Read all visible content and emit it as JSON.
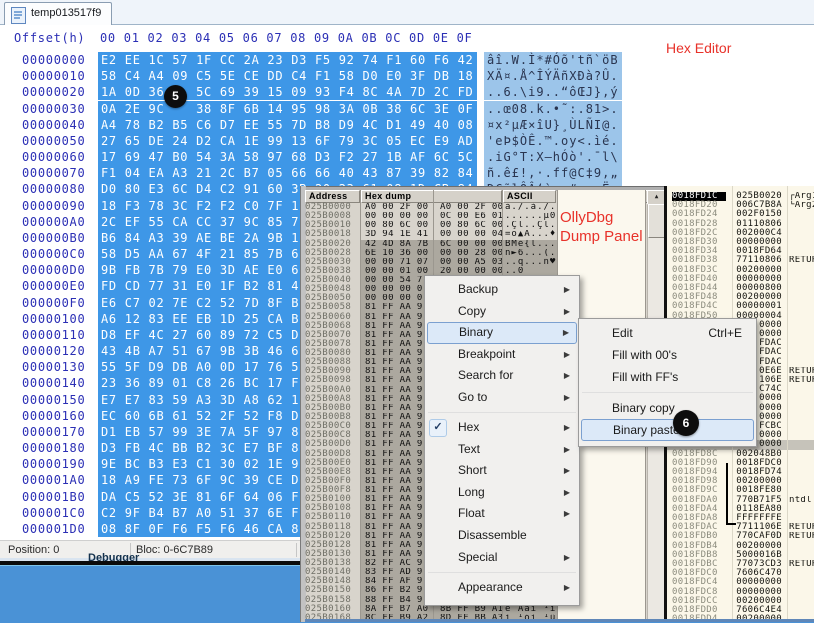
{
  "hex_editor": {
    "tab_title": "temp013517f9",
    "offset_label": "Offset(h)",
    "columns": [
      "00",
      "01",
      "02",
      "03",
      "04",
      "05",
      "06",
      "07",
      "08",
      "09",
      "0A",
      "0B",
      "0C",
      "0D",
      "0E",
      "0F"
    ],
    "rows": [
      {
        "offset": "00000000",
        "bytes": "E2 EE 1C 57 1F CC 2A 23 D3 F5 92 74 F1 60 F6 42",
        "ascii": "âî.W.Ì*#Óõ'tñ`öB"
      },
      {
        "offset": "00000010",
        "bytes": "58 C4 A4 09 C5 5E CE DD C4 F1 58 D0 E0 3F DB 18",
        "ascii": "XÄ¤.Å^ÎÝÄñXÐà?Û."
      },
      {
        "offset": "00000020",
        "bytes": "1A 0D 36    5C 69 39 15 09 93 F4 8C 4A 7D 2C FD",
        "ascii": "..6.\\i9..“ôŒJ},ý"
      },
      {
        "offset": "00000030",
        "bytes": "0A 2E 9C    38 8F 6B 14 95 98 3A 0B 38 6C 3E 0F",
        "ascii": "..œ08.k.•˜:.81>."
      },
      {
        "offset": "00000040",
        "bytes": "A4 78 B2 B5 C6 D7 EE 55 7D B8 D9 4C D1 49 40 08",
        "ascii": "¤x²µÆ×îU}¸ÙLÑI@."
      },
      {
        "offset": "00000050",
        "bytes": "27 65 DE 24 D2 CA 1E 99 13 6F 79 3C 05 EC E9 AD",
        "ascii": "'eÞ$ÒÊ.™.oy<.ìé."
      },
      {
        "offset": "00000060",
        "bytes": "17 69 47 B0 54 3A 58 97 68 D3 F2 27 1B AF 6C 5C",
        "ascii": ".iG°T:X—hÓò'.¯l\\"
      },
      {
        "offset": "00000070",
        "bytes": "F1 04 EA A3 21 2C B7 05 66 66 40 43 87 39 82 84",
        "ascii": "ñ.ê£!,·.ff@C‡9‚„"
      },
      {
        "offset": "00000080",
        "bytes": "D0 80 E3 6C D4 C2 91 60 3B 20 23 61 08 1D CB 84",
        "ascii": "Đ€ãlÔÂ‘`; #a..Ë„"
      },
      {
        "offset": "00000090",
        "bytes": "18 F3 78 3C F2 F2 C0 7F 1",
        "ascii": ""
      },
      {
        "offset": "000000A0",
        "bytes": "2C EF 55 CA CC 37 9C 85 7",
        "ascii": ""
      },
      {
        "offset": "000000B0",
        "bytes": "B6 84 A3 39 AE BE 2A 9B 1",
        "ascii": ""
      },
      {
        "offset": "000000C0",
        "bytes": "58 D5 AA 67 4F 21 85 7B 6",
        "ascii": ""
      },
      {
        "offset": "000000D0",
        "bytes": "9B FB 7B 79 E0 3D AE E0 6",
        "ascii": ""
      },
      {
        "offset": "000000E0",
        "bytes": "FD CD 77 31 E0 1F B2 81 4",
        "ascii": ""
      },
      {
        "offset": "000000F0",
        "bytes": "E6 C7 02 7E C2 52 7D 8F B",
        "ascii": ""
      },
      {
        "offset": "00000100",
        "bytes": "A6 12 83 EE EB 1D 25 CA B",
        "ascii": ""
      },
      {
        "offset": "00000110",
        "bytes": "D8 EF 4C 27 60 89 72 C5 D",
        "ascii": ""
      },
      {
        "offset": "00000120",
        "bytes": "43 4B A7 51 67 9B 3B 46 6",
        "ascii": ""
      },
      {
        "offset": "00000130",
        "bytes": "55 5F D9 DB A0 0D 17 76 5",
        "ascii": ""
      },
      {
        "offset": "00000140",
        "bytes": "23 36 89 01 C8 26 BC 17 F",
        "ascii": ""
      },
      {
        "offset": "00000150",
        "bytes": "E7 E7 83 59 A3 3D A8 62 1",
        "ascii": ""
      },
      {
        "offset": "00000160",
        "bytes": "EC 60 6B 61 52 2F 52 F8 D",
        "ascii": ""
      },
      {
        "offset": "00000170",
        "bytes": "D1 EB 57 99 3E 7A 5F 97 8",
        "ascii": ""
      },
      {
        "offset": "00000180",
        "bytes": "D3 FB 4C BB B2 3C E7 BF 8",
        "ascii": ""
      },
      {
        "offset": "00000190",
        "bytes": "9E BC B3 E3 C1 30 02 1E 9",
        "ascii": ""
      },
      {
        "offset": "000001A0",
        "bytes": "18 A9 FE 73 6F 9C 39 CE D",
        "ascii": ""
      },
      {
        "offset": "000001B0",
        "bytes": "DA C5 52 3E 81 6F 64 06 F",
        "ascii": ""
      },
      {
        "offset": "000001C0",
        "bytes": "C2 9F B4 B7 A0 51 37 6E F",
        "ascii": ""
      },
      {
        "offset": "000001D0",
        "bytes": "08 8F 0F F6 F5 F6 46 CA 8",
        "ascii": ""
      }
    ],
    "status": {
      "position": "Position: 0",
      "bloc": "Bloc: 0-6C7B89"
    },
    "background_label": "Debugger"
  },
  "annotations": {
    "hex_editor": "Hex Editor",
    "olly_line1": "OllyDbg",
    "olly_line2": "Dump Panel",
    "badge5": "5",
    "badge6": "6"
  },
  "ollydbg": {
    "dump_headers": {
      "address": "Address",
      "hex": "Hex dump",
      "ascii": "ASCII"
    },
    "scroll_up": "▲",
    "dump_rows": [
      [
        "025B0000",
        "A0 00 2F 00  A0 00 2F 00",
        "à./.à./.",
        0
      ],
      [
        "025B0008",
        "00 00 00 00  0C 00 E6 01",
        "......µ0",
        0
      ],
      [
        "025B0010",
        "00 80 6C 00  00 80 6C 00",
        ".Çl..Çl.",
        0
      ],
      [
        "025B0018",
        "3D 94 1E 41  00 00 00 04",
        "=ö▲A...♦",
        0
      ],
      [
        "025B0020",
        "42 4D 8A 7B  6C 00 00 00",
        "BMè{l...",
        1
      ],
      [
        "025B0028",
        "6E 10 36 00  00 00 28 00",
        "n►6...(.",
        1
      ],
      [
        "025B0030",
        "00 00 71 07  00 00 A5 03",
        "..q...ñ♥",
        1
      ],
      [
        "025B0038",
        "00 00 01 00  20 00 00 00",
        "..0",
        1
      ],
      [
        "025B0040",
        "00 00 54 7",
        "",
        1
      ],
      [
        "025B0048",
        "00 00 00 0",
        "",
        1
      ],
      [
        "025B0050",
        "00 00 00 0",
        "",
        1
      ],
      [
        "025B0058",
        "81 FF AA 9",
        "",
        1
      ],
      [
        "025B0060",
        "81 FF AA 9",
        "",
        1
      ],
      [
        "025B0068",
        "81 FF AA 9",
        "",
        1
      ],
      [
        "025B0070",
        "81 FF AA 9",
        "",
        1
      ],
      [
        "025B0078",
        "81 FF AA 9",
        "",
        1
      ],
      [
        "025B0080",
        "81 FF AA 9",
        "",
        1
      ],
      [
        "025B0088",
        "81 FF AA 9",
        "",
        1
      ],
      [
        "025B0090",
        "81 FF AA 9",
        "",
        1
      ],
      [
        "025B0098",
        "81 FF AA 9",
        "",
        1
      ],
      [
        "025B00A0",
        "81 FF AA 9",
        "",
        1
      ],
      [
        "025B00A8",
        "81 FF AA 9",
        "",
        1
      ],
      [
        "025B00B0",
        "81 FF AA 9",
        "",
        1
      ],
      [
        "025B00B8",
        "81 FF AA 9",
        "",
        1
      ],
      [
        "025B00C0",
        "81 FF AA 9",
        "",
        1
      ],
      [
        "025B00C8",
        "81 FF AA 9",
        "",
        1
      ],
      [
        "025B00D0",
        "81 FF AA 9",
        "",
        1
      ],
      [
        "025B00D8",
        "81 FF AA 9",
        "",
        1
      ],
      [
        "025B00E0",
        "81 FF AA 9",
        "",
        1
      ],
      [
        "025B00E8",
        "81 FF AA 9",
        "",
        1
      ],
      [
        "025B00F0",
        "81 FF AA 9",
        "",
        1
      ],
      [
        "025B00F8",
        "81 FF AA 9",
        "",
        1
      ],
      [
        "025B0100",
        "81 FF AA 9",
        "",
        1
      ],
      [
        "025B0108",
        "81 FF AA 9",
        "",
        1
      ],
      [
        "025B0110",
        "81 FF AA 9",
        "",
        1
      ],
      [
        "025B0118",
        "81 FF AA 9",
        "",
        1
      ],
      [
        "025B0120",
        "81 FF AA 9",
        "",
        1
      ],
      [
        "025B0128",
        "81 FF AA 9",
        "",
        1
      ],
      [
        "025B0130",
        "81 FF AA 9",
        "",
        1
      ],
      [
        "025B0138",
        "82 FF AC 9",
        "",
        1
      ],
      [
        "025B0140",
        "83 FF AD 9",
        "",
        1
      ],
      [
        "025B0148",
        "84 FF AF 9",
        "",
        1
      ],
      [
        "025B0150",
        "86 FF B2 9",
        "",
        1
      ],
      [
        "025B0158",
        "88 FF B4 9",
        "",
        1
      ],
      [
        "025B0160",
        "8A FF B7 A0  8B FF B9 A1",
        "è Aàì ¹ì",
        1
      ],
      [
        "025B0168",
        "8C FF B9 A2  8D FF BB A3",
        "ì ¹óì ¹û",
        1
      ]
    ],
    "stack_rows": [
      [
        "0018FD1C",
        "025B0020",
        "┌Arg1",
        "sel"
      ],
      [
        "0018FD20",
        "006C7B8A",
        "└Arg2",
        ""
      ],
      [
        "0018FD24",
        "002F0150",
        "",
        ""
      ],
      [
        "0018FD28",
        "01110806",
        "",
        ""
      ],
      [
        "0018FD2C",
        "002000C4",
        "",
        ""
      ],
      [
        "0018FD30",
        "00000000",
        "",
        ""
      ],
      [
        "0018FD34",
        "0018FD64",
        "",
        ""
      ],
      [
        "0018FD38",
        "77110806",
        "RETUR",
        ""
      ],
      [
        "0018FD3C",
        "00200000",
        "",
        ""
      ],
      [
        "0018FD40",
        "00000000",
        "",
        ""
      ],
      [
        "0018FD44",
        "00000800",
        "",
        ""
      ],
      [
        "0018FD48",
        "00200000",
        "",
        ""
      ],
      [
        "0018FD4C",
        "00000001",
        "",
        ""
      ],
      [
        "0018FD50",
        "00000004",
        "",
        ""
      ],
      [
        "0018FD54",
        "0000",
        "",
        ""
      ],
      [
        "0018FD58",
        "0000",
        "",
        ""
      ],
      [
        "0018FD5C",
        "FDAC",
        "",
        ""
      ],
      [
        "0018FD60",
        "FDAC",
        "",
        ""
      ],
      [
        "0018FD64",
        "FDAC",
        "",
        ""
      ],
      [
        "0018FD68",
        "0E6E",
        "RETUR",
        ""
      ],
      [
        "0018FD6C",
        "106E",
        "RETUR",
        ""
      ],
      [
        "0018FD70",
        "C74C",
        "",
        ""
      ],
      [
        "0018FD74",
        "0000",
        "",
        ""
      ],
      [
        "0018FD78",
        "0000",
        "",
        ""
      ],
      [
        "0018FD7C",
        "0000",
        "",
        ""
      ],
      [
        "0018FD80",
        "FCBC",
        "",
        ""
      ],
      [
        "0018FD84",
        "0000",
        "",
        ""
      ],
      [
        "0018FD88",
        "0000",
        "",
        "hl"
      ],
      [
        "0018FD8C",
        "002048B0",
        "",
        ""
      ],
      [
        "0018FD90",
        "0018FDC0",
        "",
        ""
      ],
      [
        "0018FD94",
        "0018FD74",
        "",
        ""
      ],
      [
        "0018FD98",
        "00200000",
        "",
        ""
      ],
      [
        "0018FD9C",
        "0018FE80",
        "",
        ""
      ],
      [
        "0018FDA0",
        "770B71F5",
        "ntdl",
        ""
      ],
      [
        "0018FDA4",
        "0118EA80",
        "",
        ""
      ],
      [
        "0018FDA8",
        "FFFFFFFE",
        "",
        ""
      ],
      [
        "0018FDAC",
        "7711106E",
        "RETUR",
        ""
      ],
      [
        "0018FDB0",
        "770CAF0D",
        "RETUR",
        ""
      ],
      [
        "0018FDB4",
        "00200000",
        "",
        ""
      ],
      [
        "0018FDB8",
        "5000016B",
        "",
        ""
      ],
      [
        "0018FDBC",
        "77073CD3",
        "RETUR",
        ""
      ],
      [
        "0018FDC0",
        "7606C470",
        "",
        ""
      ],
      [
        "0018FDC4",
        "00000000",
        "",
        ""
      ],
      [
        "0018FDC8",
        "00000000",
        "",
        ""
      ],
      [
        "0018FDCC",
        "00200000",
        "",
        ""
      ],
      [
        "0018FDD0",
        "7606C4E4",
        "",
        ""
      ],
      [
        "0018FDD4",
        "00200000",
        "",
        ""
      ],
      [
        "0018FDD8",
        "00300000",
        "",
        ""
      ]
    ]
  },
  "context_menu": {
    "items": [
      {
        "label": "Backup",
        "arrow": true
      },
      {
        "label": "Copy",
        "arrow": true
      },
      {
        "label": "Binary",
        "arrow": true,
        "highlight": true
      },
      {
        "label": "Breakpoint",
        "arrow": true
      },
      {
        "label": "Search for",
        "arrow": true
      },
      {
        "label": "Go to",
        "arrow": true
      },
      {
        "sep": true
      },
      {
        "label": "Hex",
        "arrow": true,
        "check": true
      },
      {
        "label": "Text",
        "arrow": true
      },
      {
        "label": "Short",
        "arrow": true
      },
      {
        "label": "Long",
        "arrow": true
      },
      {
        "label": "Float",
        "arrow": true
      },
      {
        "label": "Disassemble"
      },
      {
        "label": "Special",
        "arrow": true
      },
      {
        "sep": true
      },
      {
        "label": "Appearance",
        "arrow": true
      }
    ]
  },
  "submenu": {
    "items": [
      {
        "label": "Edit",
        "shortcut": "Ctrl+E"
      },
      {
        "label": "Fill with 00's"
      },
      {
        "label": "Fill with FF's"
      },
      {
        "sep": true
      },
      {
        "label": "Binary copy"
      },
      {
        "label": "Binary paste",
        "highlight": true
      }
    ]
  },
  "colors": {
    "selection_blue": "#3E97E7",
    "ascii_blue": "#9CC5EA",
    "annotation_red": "#E8322A",
    "olly_bg": "#D8D4CC",
    "olly_selection": "#ACA89F",
    "stack_bg": "#FBF7E9",
    "bottom_blue": "#4A92D6"
  }
}
